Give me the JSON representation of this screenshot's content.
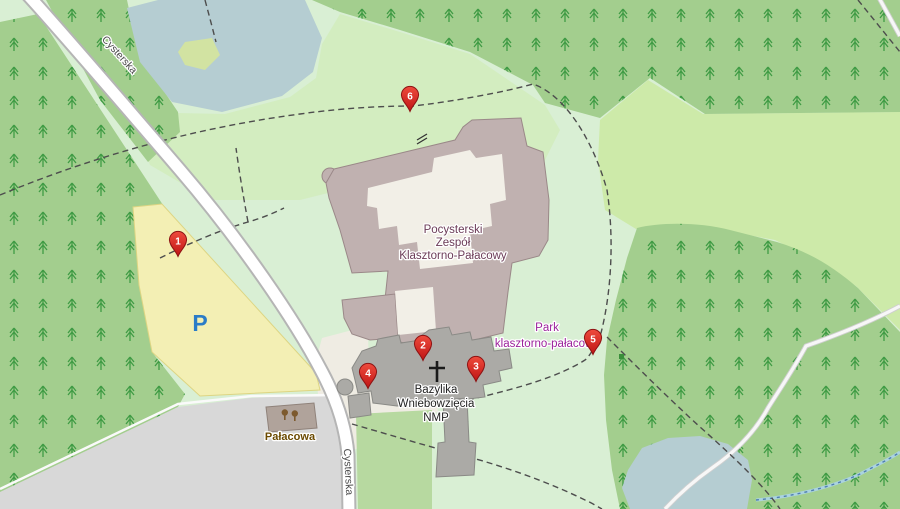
{
  "map": {
    "street_labels": {
      "top": "Cysterska",
      "bottom": "Cysterska"
    },
    "labels": {
      "complex_line1": "Pocysterski",
      "complex_line2": "Zespół",
      "complex_line3": "Klasztorno-Pałacowy",
      "basilica_line1": "Bazylika",
      "basilica_line2": "Wniebowzięcia",
      "basilica_line3": "NMP",
      "park_line1": "Park",
      "park_line2": "klasztorno-pałacowy",
      "palacowa": "Pałacowa",
      "parking_symbol": "P"
    },
    "markers": [
      {
        "number": "1"
      },
      {
        "number": "2"
      },
      {
        "number": "3"
      },
      {
        "number": "4"
      },
      {
        "number": "5"
      },
      {
        "number": "6"
      }
    ],
    "colors": {
      "park_base": "#d9efd4",
      "grass": "#cdeaa9",
      "forest": "#a3ce8e",
      "tree_glyph": "#3f9b44",
      "scrub": "#b7d9a0",
      "water": "#b5cdd2",
      "island": "#d2e3a2",
      "parking_fill": "#f3efb4",
      "paved": "#d8d8d8",
      "beige": "#efece3",
      "road": "#ffffff",
      "building_complex": "#c0b1b0",
      "building_church": "#abaaa6",
      "courtyard": "#f2efe7",
      "palacowa_building": "#b0a39b",
      "marker_red": "#d9332e",
      "marker_border": "#8e1313",
      "label_attraction": "#6b3b57",
      "label_park": "#9c239c",
      "label_street": "#4a4a4a",
      "label_palacowa": "#6b4a00",
      "parking_p": "#2a7cc7"
    }
  }
}
